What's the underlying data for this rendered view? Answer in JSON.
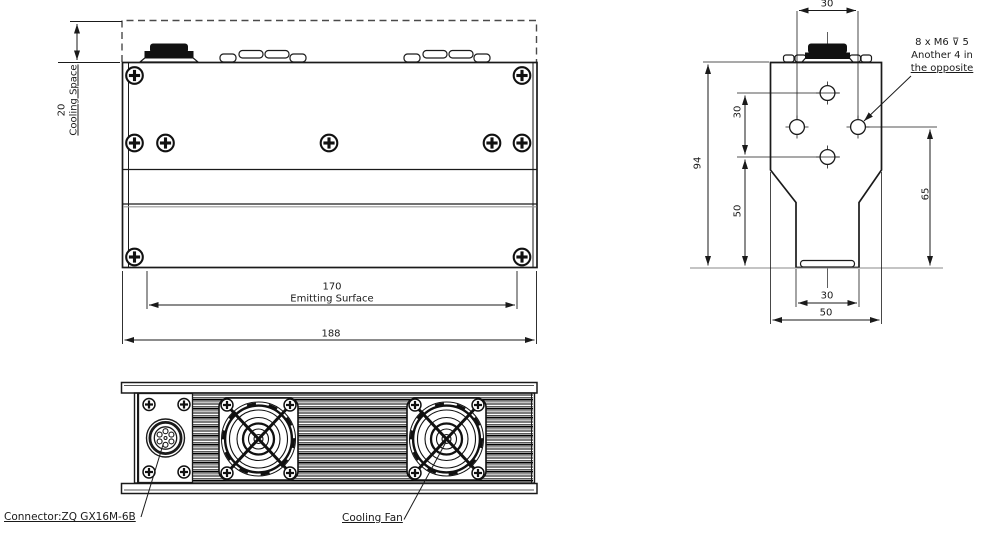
{
  "colors": {
    "line": "#1a1a1a",
    "background": "#ffffff"
  },
  "front_view": {
    "cooling_space_value": "20",
    "cooling_space_label": "Cooling Space",
    "emitting_value": "170",
    "emitting_label": "Emitting Surface",
    "overall_width": "188"
  },
  "side_view": {
    "hole_span_top": "30",
    "hole_span_vertical": "30",
    "height_total": "94",
    "hole_to_base": "50",
    "side_hole_to_base": "65",
    "base_width": "30",
    "overall_width": "50",
    "thread_note_line1": "8 x M6 ⊽ 5",
    "thread_note_line2": "Another 4 in",
    "thread_note_line3": "the opposite"
  },
  "bottom_view": {
    "connector_label": "Connector:ZQ GX16M-6B",
    "fan_label": "Cooling Fan"
  }
}
